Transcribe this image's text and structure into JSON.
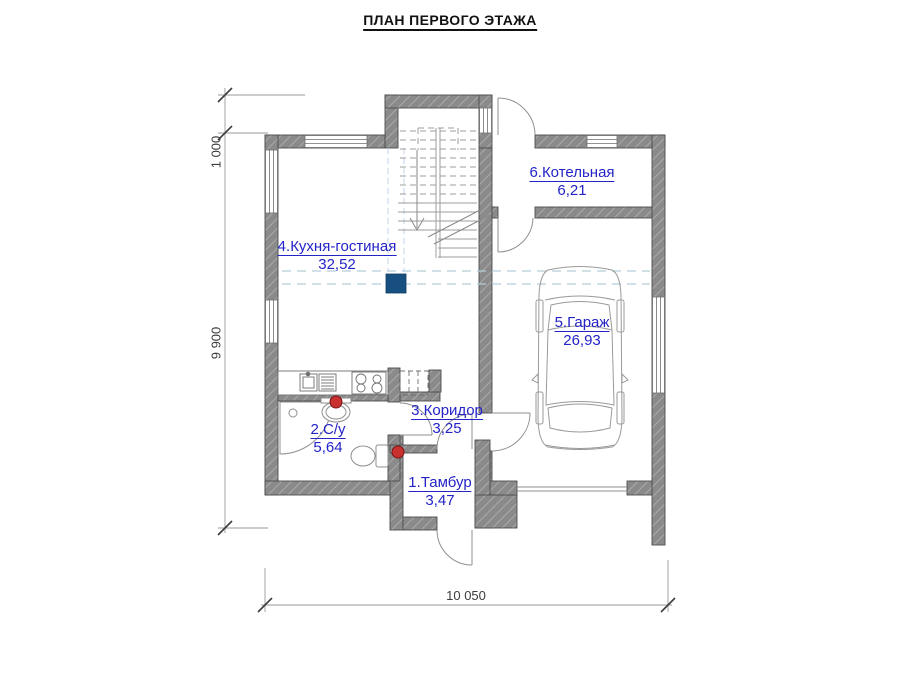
{
  "title": "ПЛАН ПЕРВОГО ЭТАЖА",
  "rooms": [
    {
      "name": "1.Тамбур",
      "area": "3,47"
    },
    {
      "name": "2.С/у",
      "area": "5,64"
    },
    {
      "name": "3.Коридор",
      "area": "3,25"
    },
    {
      "name": "4.Кухня-гостиная",
      "area": "32,52"
    },
    {
      "name": "5.Гараж",
      "area": "26,93"
    },
    {
      "name": "6.Котельная",
      "area": "6,21"
    }
  ],
  "dimensions": {
    "left_top": "1 000",
    "left_main": "9 900",
    "bottom": "10 050"
  },
  "colors": {
    "room_label": "#2323c8",
    "wall_fill": "#8a8a8a",
    "wall_hatch": "#a8a8a8",
    "dashed_guide": "#b5ced8",
    "marker_blue": "#175080",
    "marker_red": "#c93030",
    "dimension": "#3c3c3c"
  }
}
